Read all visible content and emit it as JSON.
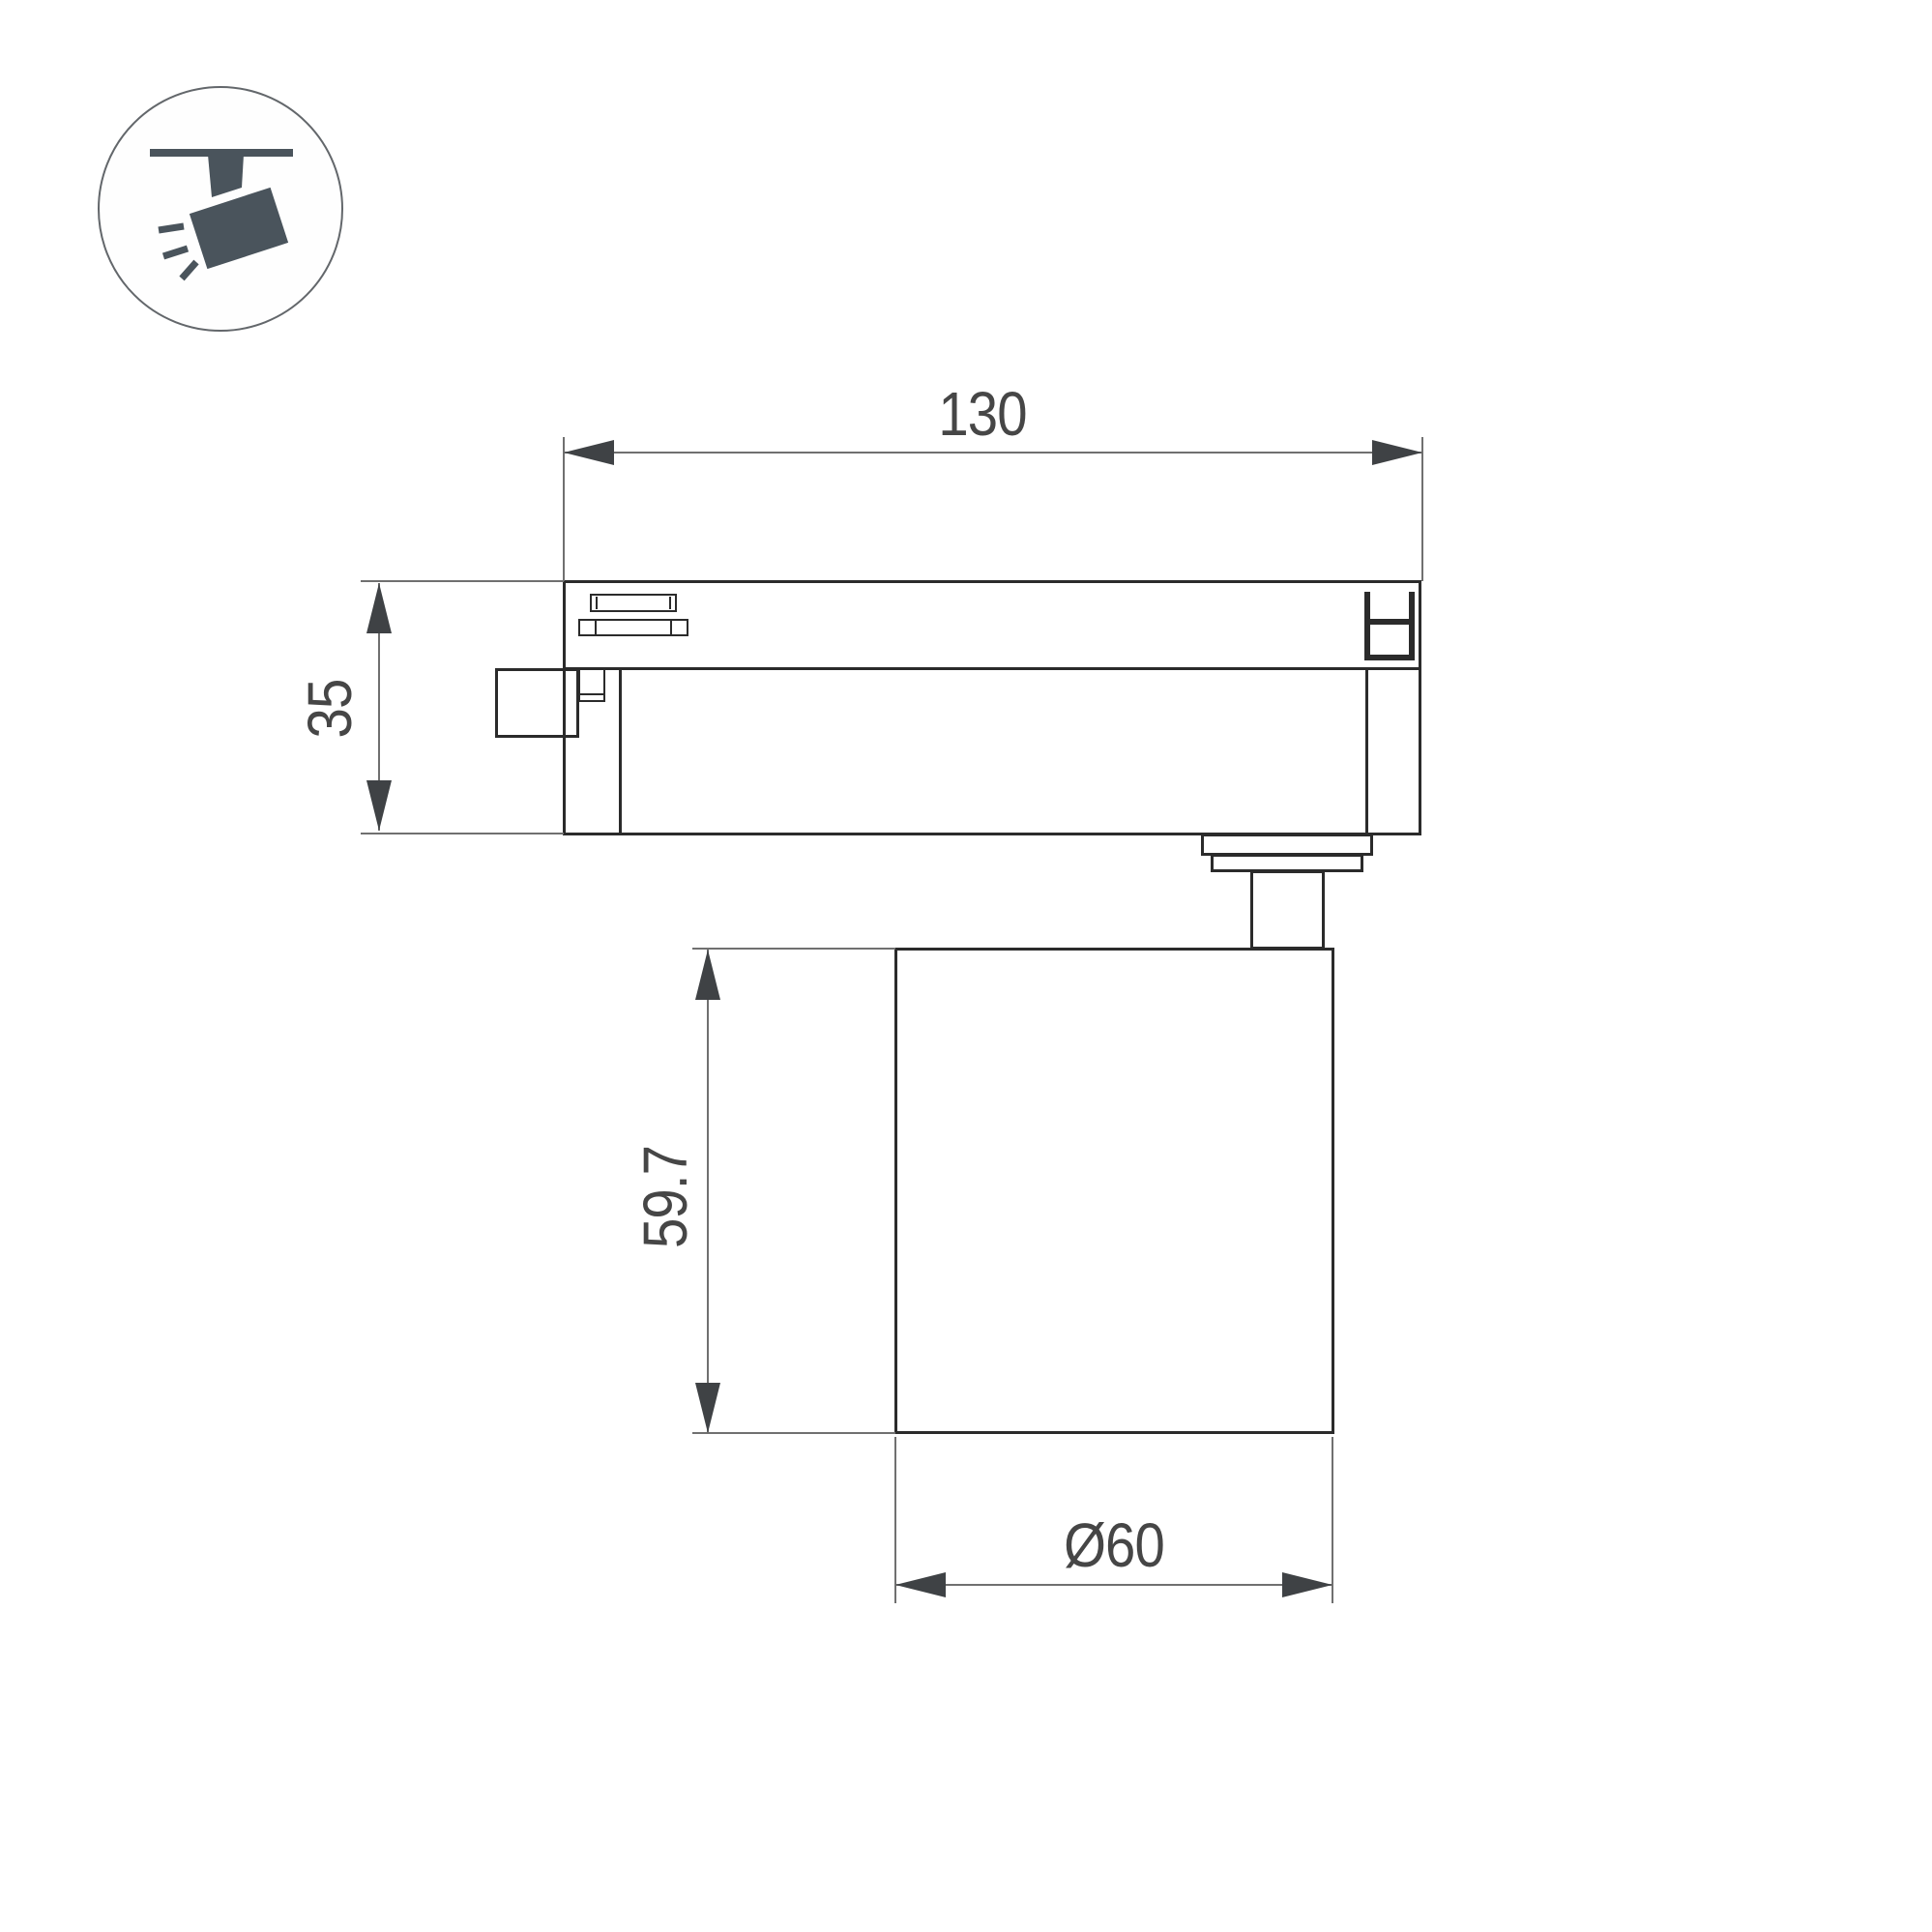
{
  "page": {
    "background": "#ffffff"
  },
  "icon": {
    "label": "track-mounted-spotlight-symbol",
    "color": "#4a545c",
    "circle_stroke": "#63676b"
  },
  "dimensions": {
    "width": "130",
    "adapter_height": "35",
    "lamp_height": "59.7",
    "lamp_diameter": "Ø60"
  },
  "colors": {
    "outline": "#2b2b2b",
    "dimension_line": "#707070",
    "arrow": "#3f4245",
    "label_text": "#464646"
  }
}
